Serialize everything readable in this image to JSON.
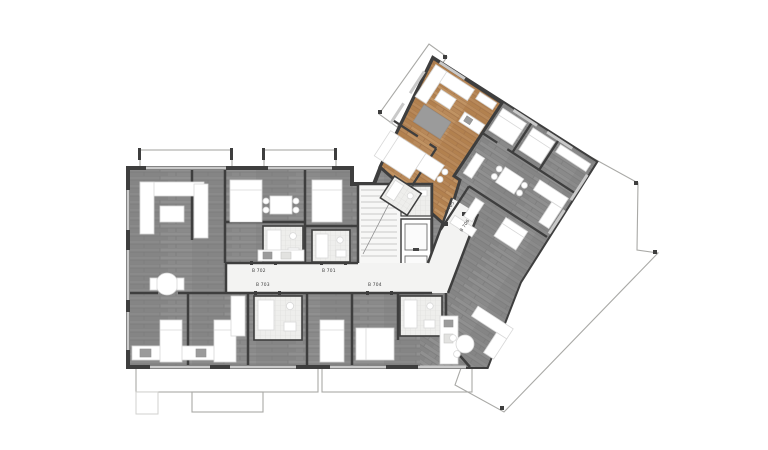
{
  "plan": {
    "title": "residential floor plan",
    "labels": {
      "b701": "B 701",
      "b702": "B 702",
      "b703": "B 703",
      "b704": "B 704",
      "b705": "B 705",
      "b706": "B 706"
    },
    "unit_labels": [
      "B 701",
      "B 702",
      "B 703",
      "B 704",
      "B 705",
      "B 706"
    ],
    "highlighted_unit_floor_color": "#b8895a",
    "colors": {
      "background": "#ffffff",
      "wall": "#3e3e3e",
      "gray_floor": "#8a8a8a",
      "wood_floor": "#b8895a",
      "balcony_tile": "#e6e6e3",
      "corridor": "#f3f3f2",
      "bathroom_tile": "#eeeeec",
      "furniture": "#ffffff"
    },
    "features": [
      "stairs",
      "elevator",
      "balconies",
      "terrace",
      "highlighted-apartment"
    ]
  }
}
